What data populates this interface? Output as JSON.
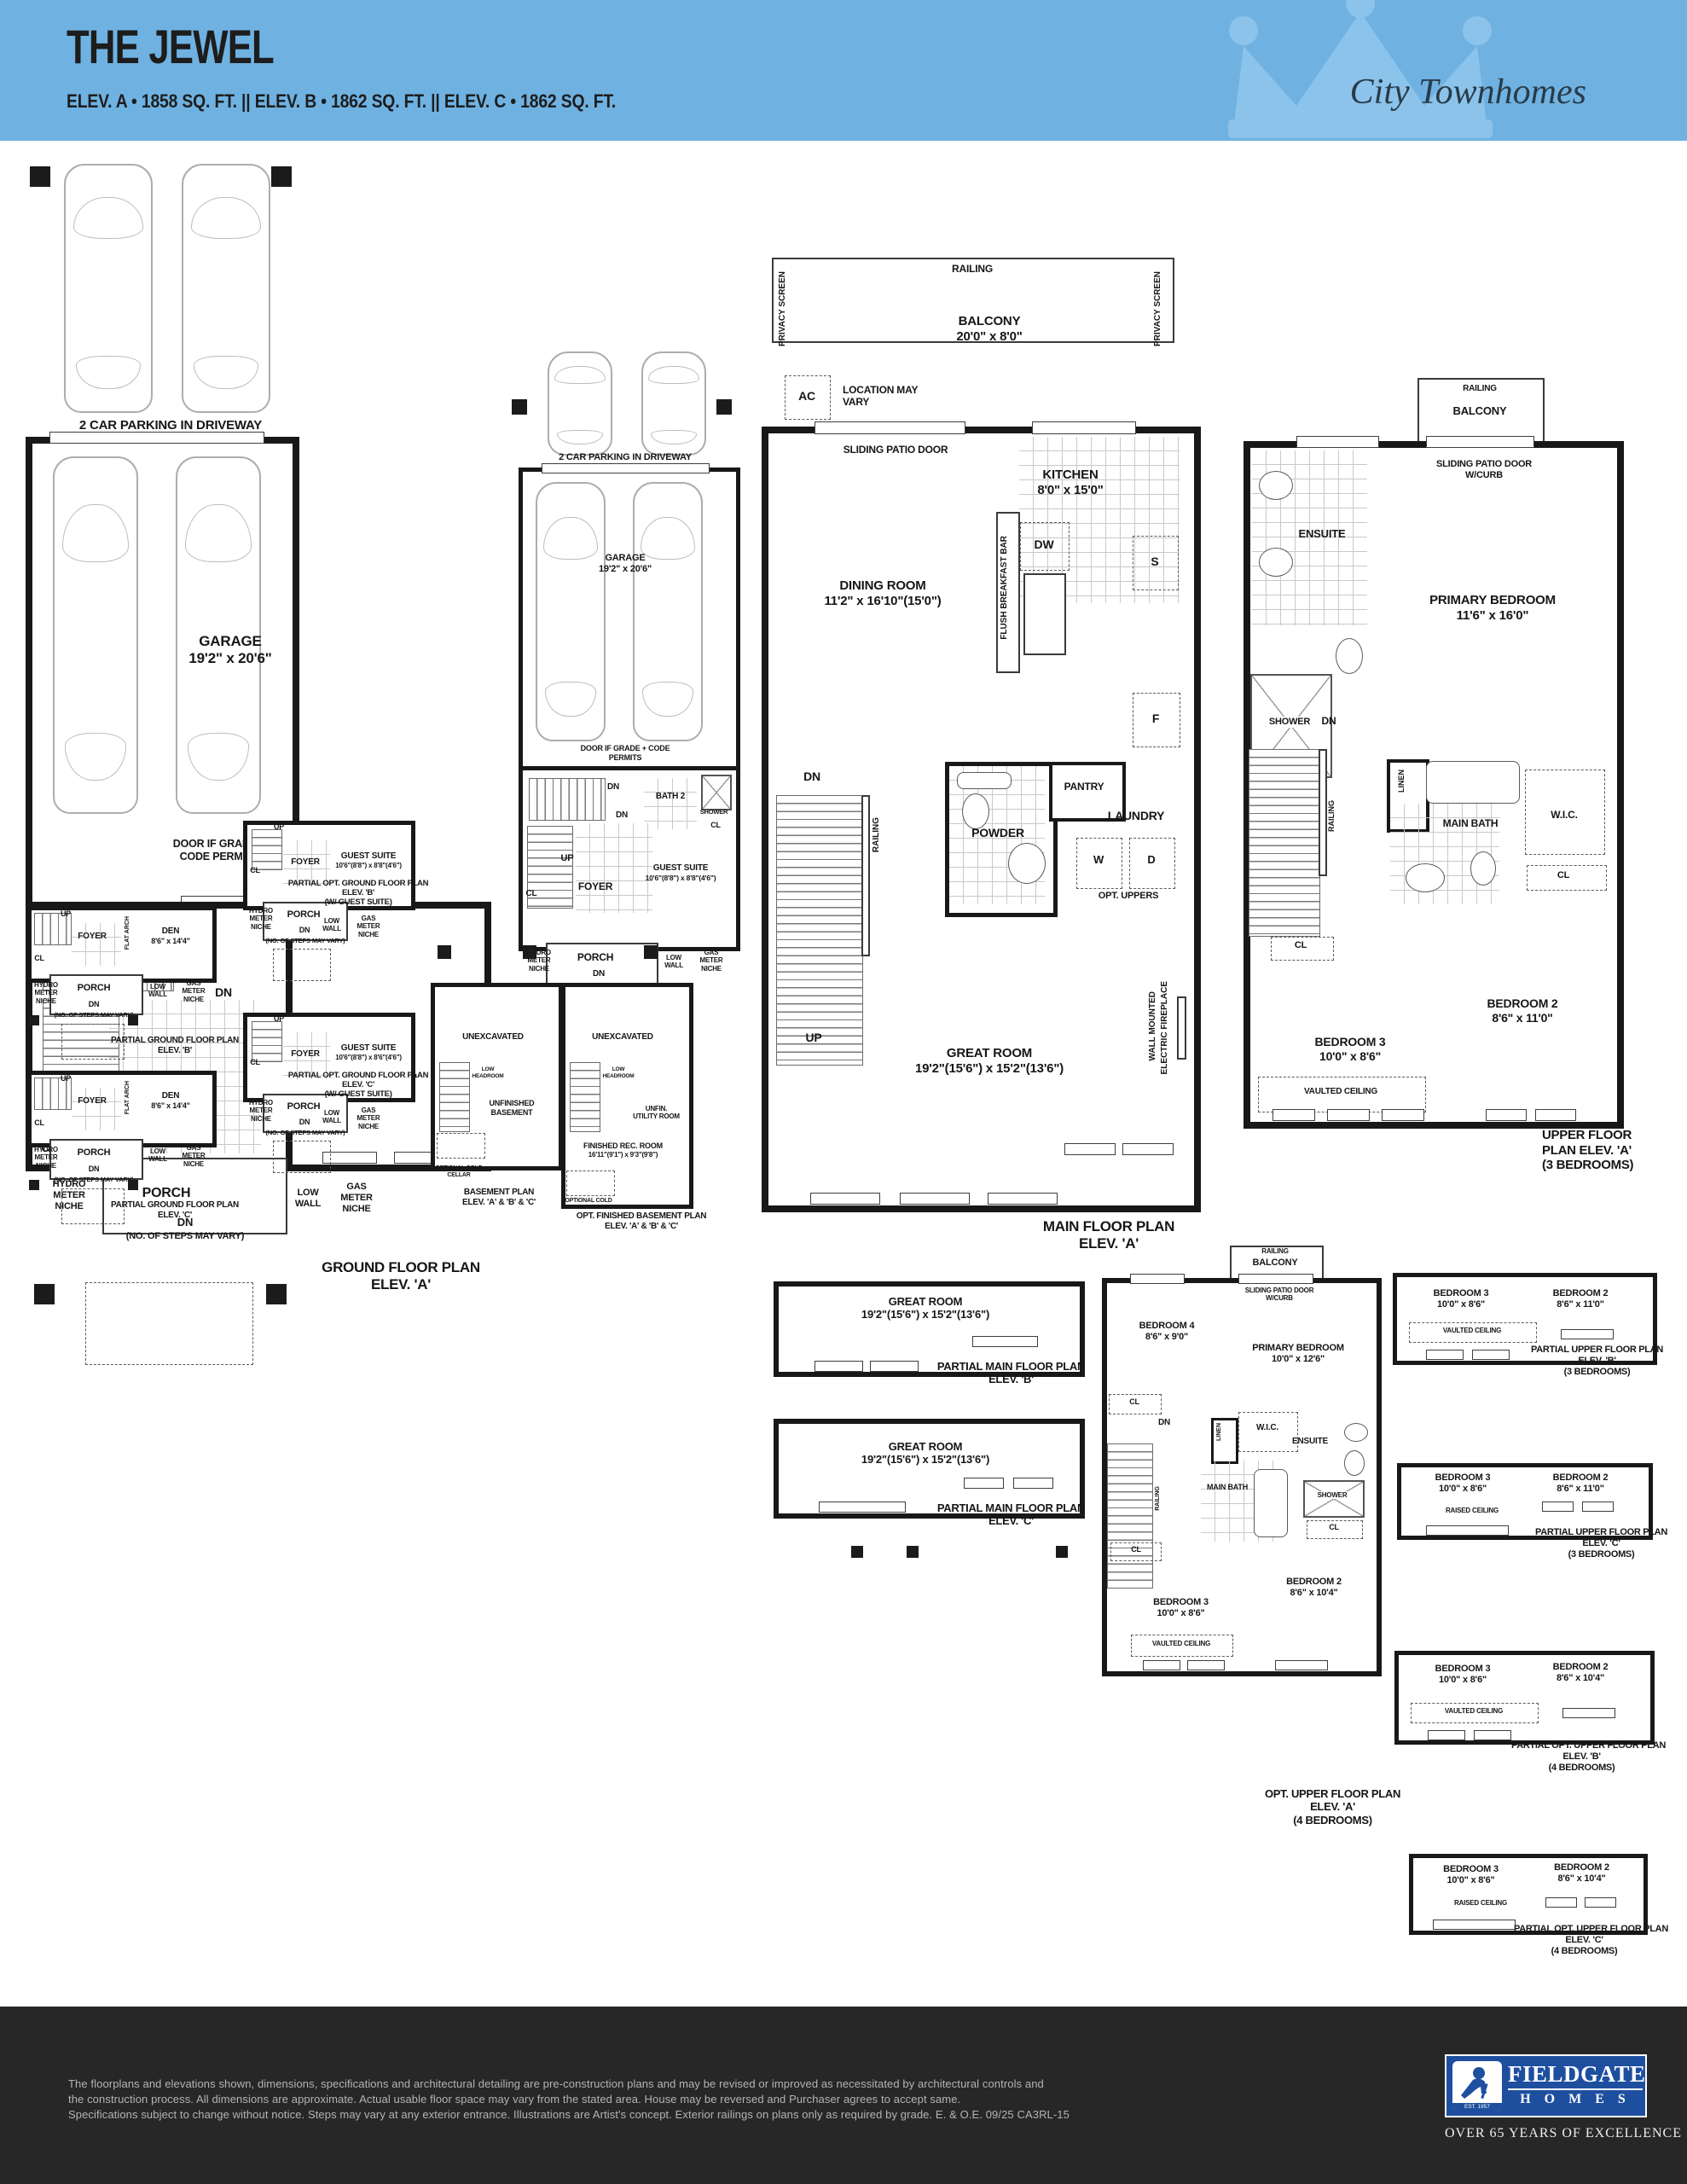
{
  "header": {
    "title": "THE JEWEL",
    "specs": "ELEV. A • 1858 SQ. FT.  ||  ELEV. B • 1862 SQ. FT.  ||  ELEV. C • 1862 SQ. FT.",
    "brand": "City Townhomes"
  },
  "ground_a": {
    "parking": "2 CAR PARKING IN DRIVEWAY",
    "garage": "GARAGE",
    "garage_dims": "19'2\" x 20'6\"",
    "door_note": "DOOR IF GRADE + CODE PERMITS",
    "dn": "DN",
    "dn2": "DN",
    "up": "UP",
    "foyer": "FOYER",
    "cl": "CL",
    "flat_arch": "FLAT ARCH",
    "den": "DEN",
    "den_dims": "8'6\" x 14'4\"",
    "hydro": "HYDRO METER NICHE",
    "porch": "PORCH",
    "dn3": "DN",
    "steps": "(NO. OF STEPS MAY VARY)",
    "low_wall": "LOW WALL",
    "gas": "GAS METER NICHE",
    "cap1": "GROUND FLOOR PLAN",
    "cap2": "ELEV. 'A'"
  },
  "opt_ground_a": {
    "parking": "2 CAR PARKING IN DRIVEWAY",
    "garage": "GARAGE",
    "garage_dims": "19'2\" x 20'6\"",
    "door_note": "DOOR IF GRADE + CODE PERMITS",
    "dn": "DN",
    "dn2": "DN",
    "up": "UP",
    "foyer": "FOYER",
    "cl": "CL",
    "bath2": "BATH 2",
    "shower": "SHOWER",
    "cl2": "CL",
    "guest": "GUEST SUITE",
    "guest_dims": "10'6\"(8'8\") x 8'8\"(4'6\")",
    "hydro": "HYDRO METER NICHE",
    "porch": "PORCH",
    "dn3": "DN",
    "steps": "(NO. OF STEPS MAY VARY)",
    "low_wall": "LOW WALL",
    "gas": "GAS METER NICHE",
    "cap1": "OPT. GROUND FLOOR PLAN",
    "cap2": "ELEV. 'A'",
    "cap3": "(W/ GUEST SUITE)"
  },
  "main_a": {
    "railing": "RAILING",
    "privacy_l": "PRIVACY SCREEN",
    "privacy_r": "PRIVACY SCREEN",
    "balcony": "BALCONY",
    "balcony_dims": "20'0\" x 8'0\"",
    "ac": "AC",
    "location": "LOCATION MAY VARY",
    "sliding": "SLIDING PATIO DOOR",
    "kitchen": "KITCHEN",
    "kitchen_dims": "8'0\" x 15'0\"",
    "dw": "DW",
    "s": "S",
    "f": "F",
    "flush": "FLUSH BREAKFAST BAR",
    "dining": "DINING ROOM",
    "dining_dims": "11'2\" x 16'10\"(15'0\")",
    "dn": "DN",
    "railing2": "RAILING",
    "up": "UP",
    "pantry": "PANTRY",
    "powder": "POWDER",
    "laundry": "LAUNDRY",
    "w": "W",
    "d": "D",
    "opt_uppers": "OPT. UPPERS",
    "fp1": "WALL MOUNTED",
    "fp2": "ELECTRIC FIREPLACE",
    "great": "GREAT ROOM",
    "great_dims": "19'2\"(15'6\") x 15'2\"(13'6\")",
    "cap1": "MAIN FLOOR PLAN",
    "cap2": "ELEV. 'A'"
  },
  "upper_a": {
    "railing": "RAILING",
    "balcony": "BALCONY",
    "sliding1": "SLIDING PATIO DOOR",
    "sliding2": "W/CURB",
    "ensuite": "ENSUITE",
    "shower": "SHOWER",
    "primary": "PRIMARY BEDROOM",
    "primary_dims": "11'6\" x 16'0\"",
    "dn": "DN",
    "railing2": "RAILING",
    "linen": "LINEN",
    "main_bath": "MAIN BATH",
    "wic": "W.I.C.",
    "cl": "CL",
    "cl2": "CL",
    "bed3": "BEDROOM 3",
    "bed3_dims": "10'0\" x 8'6\"",
    "bed2": "BEDROOM 2",
    "bed2_dims": "8'6\" x 11'0\"",
    "vaulted": "VAULTED CEILING",
    "cap1": "UPPER FLOOR",
    "cap2": "PLAN ELEV. 'A'",
    "cap3": "(3 BEDROOMS)"
  },
  "partial_main_b": {
    "great": "GREAT ROOM",
    "great_dims": "19'2\"(15'6\") x 15'2\"(13'6\")",
    "cap1": "PARTIAL MAIN FLOOR PLAN",
    "cap2": "ELEV. 'B'"
  },
  "partial_main_c": {
    "great": "GREAT ROOM",
    "great_dims": "19'2\"(15'6\") x 15'2\"(13'6\")",
    "cap1": "PARTIAL MAIN FLOOR PLAN",
    "cap2": "ELEV. 'C'"
  },
  "opt_upper_a4": {
    "railing": "RAILING",
    "balcony": "BALCONY",
    "sliding1": "SLIDING PATIO DOOR",
    "sliding2": "W/CURB",
    "bed4": "BEDROOM 4",
    "bed4_dims": "8'6\" x 9'0\"",
    "primary": "PRIMARY BEDROOM",
    "primary_dims": "10'0\" x 12'6\"",
    "cl": "CL",
    "dn": "DN",
    "linen": "LINEN",
    "wic": "W.I.C.",
    "ensuite": "ENSUITE",
    "railing2": "RAILING",
    "main_bath": "MAIN BATH",
    "shower": "SHOWER",
    "cl2": "CL",
    "cl3": "CL",
    "bed3": "BEDROOM 3",
    "bed3_dims": "10'0\" x 8'6\"",
    "bed2": "BEDROOM 2",
    "bed2_dims": "8'6\" x 10'4\"",
    "vaulted": "VAULTED CEILING",
    "cap1": "OPT. UPPER FLOOR PLAN",
    "cap2": "ELEV. 'A'",
    "cap3": "(4 BEDROOMS)"
  },
  "pu_b3": {
    "bed3": "BEDROOM 3",
    "bed3_dims": "10'0\" x 8'6\"",
    "bed2": "BEDROOM 2",
    "bed2_dims": "8'6\" x 11'0\"",
    "ceiling": "VAULTED CEILING",
    "cap1": "PARTIAL UPPER FLOOR PLAN",
    "cap2": "ELEV. 'B'",
    "cap3": "(3 BEDROOMS)"
  },
  "pu_c3": {
    "bed3": "BEDROOM 3",
    "bed3_dims": "10'0\" x 8'6\"",
    "bed2": "BEDROOM 2",
    "bed2_dims": "8'6\" x 11'0\"",
    "ceiling": "RAISED CEILING",
    "cap1": "PARTIAL UPPER FLOOR PLAN",
    "cap2": "ELEV. 'C'",
    "cap3": "(3 BEDROOMS)"
  },
  "pu_b4": {
    "bed3": "BEDROOM 3",
    "bed3_dims": "10'0\" x 8'6\"",
    "bed2": "BEDROOM 2",
    "bed2_dims": "8'6\" x 10'4\"",
    "ceiling": "VAULTED CEILING",
    "cap1": "PARTIAL OPT. UPPER FLOOR PLAN",
    "cap2": "ELEV. 'B'",
    "cap3": "(4 BEDROOMS)"
  },
  "pu_c4": {
    "bed3": "BEDROOM 3",
    "bed3_dims": "10'0\" x 8'6\"",
    "bed2": "BEDROOM 2",
    "bed2_dims": "8'6\" x 10'4\"",
    "ceiling": "RAISED CEILING",
    "cap1": "PARTIAL OPT. UPPER FLOOR PLAN",
    "cap2": "ELEV. 'C'",
    "cap3": "(4 BEDROOMS)"
  },
  "pg_b": {
    "up": "UP",
    "foyer": "FOYER",
    "cl": "CL",
    "flat_arch": "FLAT ARCH",
    "den": "DEN",
    "den_dims": "8'6\" x 14'4\"",
    "hydro": "HYDRO METER NICHE",
    "porch": "PORCH",
    "dn": "DN",
    "steps": "(NO. OF STEPS MAY VARY)",
    "low_wall": "LOW WALL",
    "gas": "GAS METER NICHE",
    "cap1": "PARTIAL GROUND FLOOR PLAN",
    "cap2": "ELEV. 'B'"
  },
  "pg_c": {
    "up": "UP",
    "foyer": "FOYER",
    "cl": "CL",
    "flat_arch": "FLAT ARCH",
    "den": "DEN",
    "den_dims": "8'6\" x 14'4\"",
    "hydro": "HYDRO METER NICHE",
    "porch": "PORCH",
    "dn": "DN",
    "steps": "(NO. OF STEPS MAY VARY)",
    "low_wall": "LOW WALL",
    "gas": "GAS METER NICHE",
    "cap1": "PARTIAL GROUND FLOOR PLAN",
    "cap2": "ELEV. 'C'"
  },
  "pog_b": {
    "up": "UP",
    "foyer": "FOYER",
    "cl": "CL",
    "guest": "GUEST SUITE",
    "guest_dims": "10'6\"(8'8\") x 8'8\"(4'6\")",
    "hydro": "HYDRO METER NICHE",
    "porch": "PORCH",
    "dn": "DN",
    "steps": "(NO. OF STEPS MAY VARY)",
    "low_wall": "LOW WALL",
    "gas": "GAS METER NICHE",
    "cap1": "PARTIAL OPT. GROUND FLOOR PLAN",
    "cap2": "ELEV. 'B'",
    "cap3": "(W/ GUEST SUITE)"
  },
  "pog_c": {
    "up": "UP",
    "foyer": "FOYER",
    "cl": "CL",
    "guest": "GUEST SUITE",
    "guest_dims": "10'6\"(8'8\") x 8'6\"(4'6\")",
    "hydro": "HYDRO METER NICHE",
    "porch": "PORCH",
    "dn": "DN",
    "steps": "(NO. OF STEPS MAY VARY)",
    "low_wall": "LOW WALL",
    "gas": "GAS METER NICHE",
    "cap1": "PARTIAL OPT. GROUND FLOOR PLAN",
    "cap2": "ELEV. 'C'",
    "cap3": "(W/ GUEST SUITE)"
  },
  "bsmt": {
    "unex": "UNEXCAVATED",
    "low_head": "LOW HEADROOM",
    "unfin": "UNFINISHED BASEMENT",
    "cold": "OPTIONAL COLD CELLAR",
    "cap1": "BASEMENT PLAN",
    "cap2": "ELEV. 'A' & 'B' & 'C'"
  },
  "opt_bsmt": {
    "unex": "UNEXCAVATED",
    "low_head": "LOW HEADROOM",
    "util": "UNFIN. UTILITY ROOM",
    "rec": "FINISHED REC. ROOM",
    "rec_dims": "16'11\"(9'1\") x 9'3\"(9'8\")",
    "cold": "OPTIONAL COLD CELLAR",
    "cap1": "OPT. FINISHED BASEMENT PLAN",
    "cap2": "ELEV. 'A' & 'B' & 'C'"
  },
  "footer": {
    "line1": "The floorplans and elevations shown, dimensions, specifications and architectural detailing are pre-construction plans and may be revised or improved as necessitated by architectural controls and",
    "line2": "the construction process. All dimensions are approximate. Actual usable floor space may vary from the stated area. House may be reversed and Purchaser agrees to accept same.",
    "line3": "Specifications subject to change without notice. Steps may vary at any exterior entrance. Illustrations are Artist's concept. Exterior railings on plans only as required by grade. E. & O.E. 09/25  CA3RL-15",
    "logo_name": "FIELDGATE",
    "logo_homes": "H O M E S",
    "logo_est": "EST. 1957",
    "tagline": "OVER 65 YEARS OF EXCELLENCE"
  },
  "colors": {
    "header_bg": "#6fb2e2",
    "crown": "#8cc3eb",
    "wall": "#181818",
    "footer_bg": "#272727",
    "logo_blue": "#1e4f9f"
  }
}
